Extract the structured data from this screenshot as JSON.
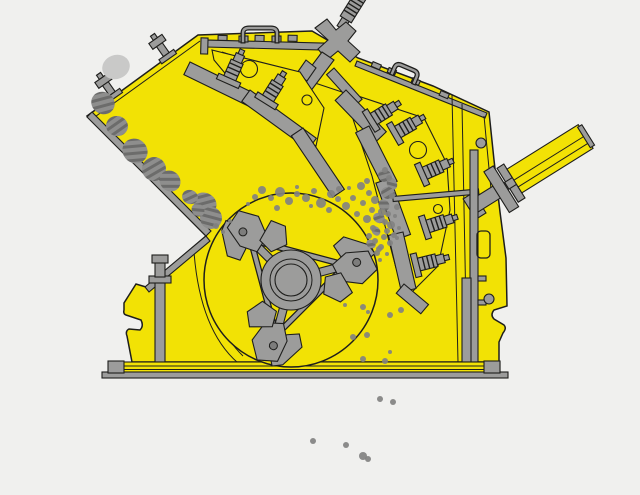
{
  "title": "Impact crusher cross-section schematic diagram",
  "machine": {
    "kind": "horizontal-shaft-impact-crusher",
    "view": "side-section"
  },
  "colors": {
    "background": "#f0f0ee",
    "body_yellow": "#f2e205",
    "outline": "#1e1e1c",
    "metal": "#9c9c9b",
    "metal_dark": "#7d7d7c",
    "metal_light": "#b6b6b5",
    "rock": "#8e8e8d",
    "rock_stripe": "#6c6c6b",
    "rock_light": "#c9c9c8",
    "particle": "#828281"
  },
  "parts": [
    "crusher-housing",
    "feed-opening",
    "feed-chute-liner",
    "upper-impact-apron",
    "lower-impact-apron",
    "spring-bolt",
    "rotor",
    "rotor-hub",
    "blow-bar-hammer",
    "apron-tension-rod",
    "hydraulic-adjusting-cylinder",
    "lifting-handle",
    "threaded-suspension-rod",
    "base-frame-rail",
    "support-foot"
  ],
  "rocks": [
    {
      "x": 116,
      "y": 67,
      "rx": 14,
      "ry": 12,
      "rot": -20,
      "light": true
    },
    {
      "x": 103,
      "y": 103,
      "rx": 12,
      "ry": 11,
      "rot": 30,
      "light": false
    },
    {
      "x": 117,
      "y": 126,
      "rx": 11,
      "ry": 10,
      "rot": 10,
      "light": false
    },
    {
      "x": 135,
      "y": 151,
      "rx": 13,
      "ry": 12,
      "rot": 40,
      "light": false
    },
    {
      "x": 154,
      "y": 169,
      "rx": 12,
      "ry": 12,
      "rot": 15,
      "light": false
    },
    {
      "x": 170,
      "y": 181,
      "rx": 11,
      "ry": 10,
      "rot": 45,
      "light": false
    },
    {
      "x": 205,
      "y": 203,
      "rx": 12,
      "ry": 10,
      "rot": 30,
      "light": false
    },
    {
      "x": 211,
      "y": 218,
      "rx": 11,
      "ry": 11,
      "rot": 60,
      "light": false
    },
    {
      "x": 190,
      "y": 197,
      "rx": 8,
      "ry": 7,
      "rot": 20,
      "light": false
    },
    {
      "x": 198,
      "y": 210,
      "rx": 7,
      "ry": 6,
      "rot": 50,
      "light": false
    },
    {
      "x": 385,
      "y": 176,
      "rx": 7,
      "ry": 6,
      "rot": 30,
      "light": false
    },
    {
      "x": 392,
      "y": 184,
      "rx": 6,
      "ry": 5,
      "rot": 60,
      "light": false
    },
    {
      "x": 388,
      "y": 193,
      "rx": 7,
      "ry": 6,
      "rot": 15,
      "light": false
    },
    {
      "x": 384,
      "y": 205,
      "rx": 6,
      "ry": 5,
      "rot": 45,
      "light": false
    },
    {
      "x": 379,
      "y": 218,
      "rx": 6,
      "ry": 5,
      "rot": 25,
      "light": false
    },
    {
      "x": 376,
      "y": 231,
      "rx": 5,
      "ry": 4,
      "rot": 55,
      "light": false
    },
    {
      "x": 371,
      "y": 244,
      "rx": 5,
      "ry": 4,
      "rot": 35,
      "light": false
    }
  ],
  "particles": [
    [
      262,
      190,
      4
    ],
    [
      271,
      198,
      3
    ],
    [
      280,
      192,
      5
    ],
    [
      289,
      201,
      4
    ],
    [
      297,
      194,
      3
    ],
    [
      277,
      208,
      3
    ],
    [
      306,
      198,
      4
    ],
    [
      314,
      191,
      3
    ],
    [
      321,
      203,
      5
    ],
    [
      331,
      194,
      4
    ],
    [
      339,
      189,
      3
    ],
    [
      338,
      199,
      3
    ],
    [
      346,
      206,
      4
    ],
    [
      329,
      210,
      3
    ],
    [
      353,
      198,
      3
    ],
    [
      361,
      186,
      4
    ],
    [
      367,
      181,
      3
    ],
    [
      369,
      193,
      3
    ],
    [
      375,
      200,
      4
    ],
    [
      363,
      203,
      3
    ],
    [
      357,
      214,
      3
    ],
    [
      367,
      219,
      4
    ],
    [
      373,
      228,
      3
    ],
    [
      369,
      236,
      3
    ],
    [
      375,
      241,
      3
    ],
    [
      382,
      212,
      4
    ],
    [
      388,
      214,
      3
    ],
    [
      385,
      222,
      3
    ],
    [
      391,
      225,
      4
    ],
    [
      387,
      231,
      3
    ],
    [
      394,
      235,
      3
    ],
    [
      390,
      243,
      3
    ],
    [
      381,
      247,
      3
    ],
    [
      377,
      253,
      3
    ],
    [
      372,
      210,
      3
    ],
    [
      349,
      188,
      2
    ],
    [
      297,
      187,
      2
    ],
    [
      311,
      206,
      2
    ],
    [
      255,
      197,
      3
    ],
    [
      248,
      204,
      2
    ],
    [
      385,
      170,
      3
    ],
    [
      389,
      178,
      3
    ],
    [
      392,
      196,
      3
    ],
    [
      397,
      207,
      3
    ],
    [
      395,
      216,
      2
    ],
    [
      399,
      228,
      2
    ],
    [
      397,
      238,
      2
    ],
    [
      387,
      254,
      2
    ],
    [
      380,
      260,
      2
    ],
    [
      216,
      226,
      3
    ],
    [
      223,
      232,
      2
    ],
    [
      230,
      221,
      2
    ],
    [
      363,
      307,
      3
    ],
    [
      368,
      312,
      2
    ],
    [
      390,
      315,
      3
    ],
    [
      401,
      310,
      3
    ],
    [
      353,
      337,
      3
    ],
    [
      367,
      335,
      3
    ],
    [
      363,
      359,
      3
    ],
    [
      385,
      361,
      3
    ],
    [
      390,
      352,
      2
    ],
    [
      345,
      305,
      2
    ],
    [
      384,
      237,
      3
    ],
    [
      379,
      249,
      3
    ],
    [
      380,
      399,
      3
    ],
    [
      393,
      402,
      3
    ],
    [
      313,
      441,
      3
    ],
    [
      346,
      445,
      3
    ],
    [
      363,
      456,
      4
    ],
    [
      368,
      459,
      3
    ]
  ]
}
